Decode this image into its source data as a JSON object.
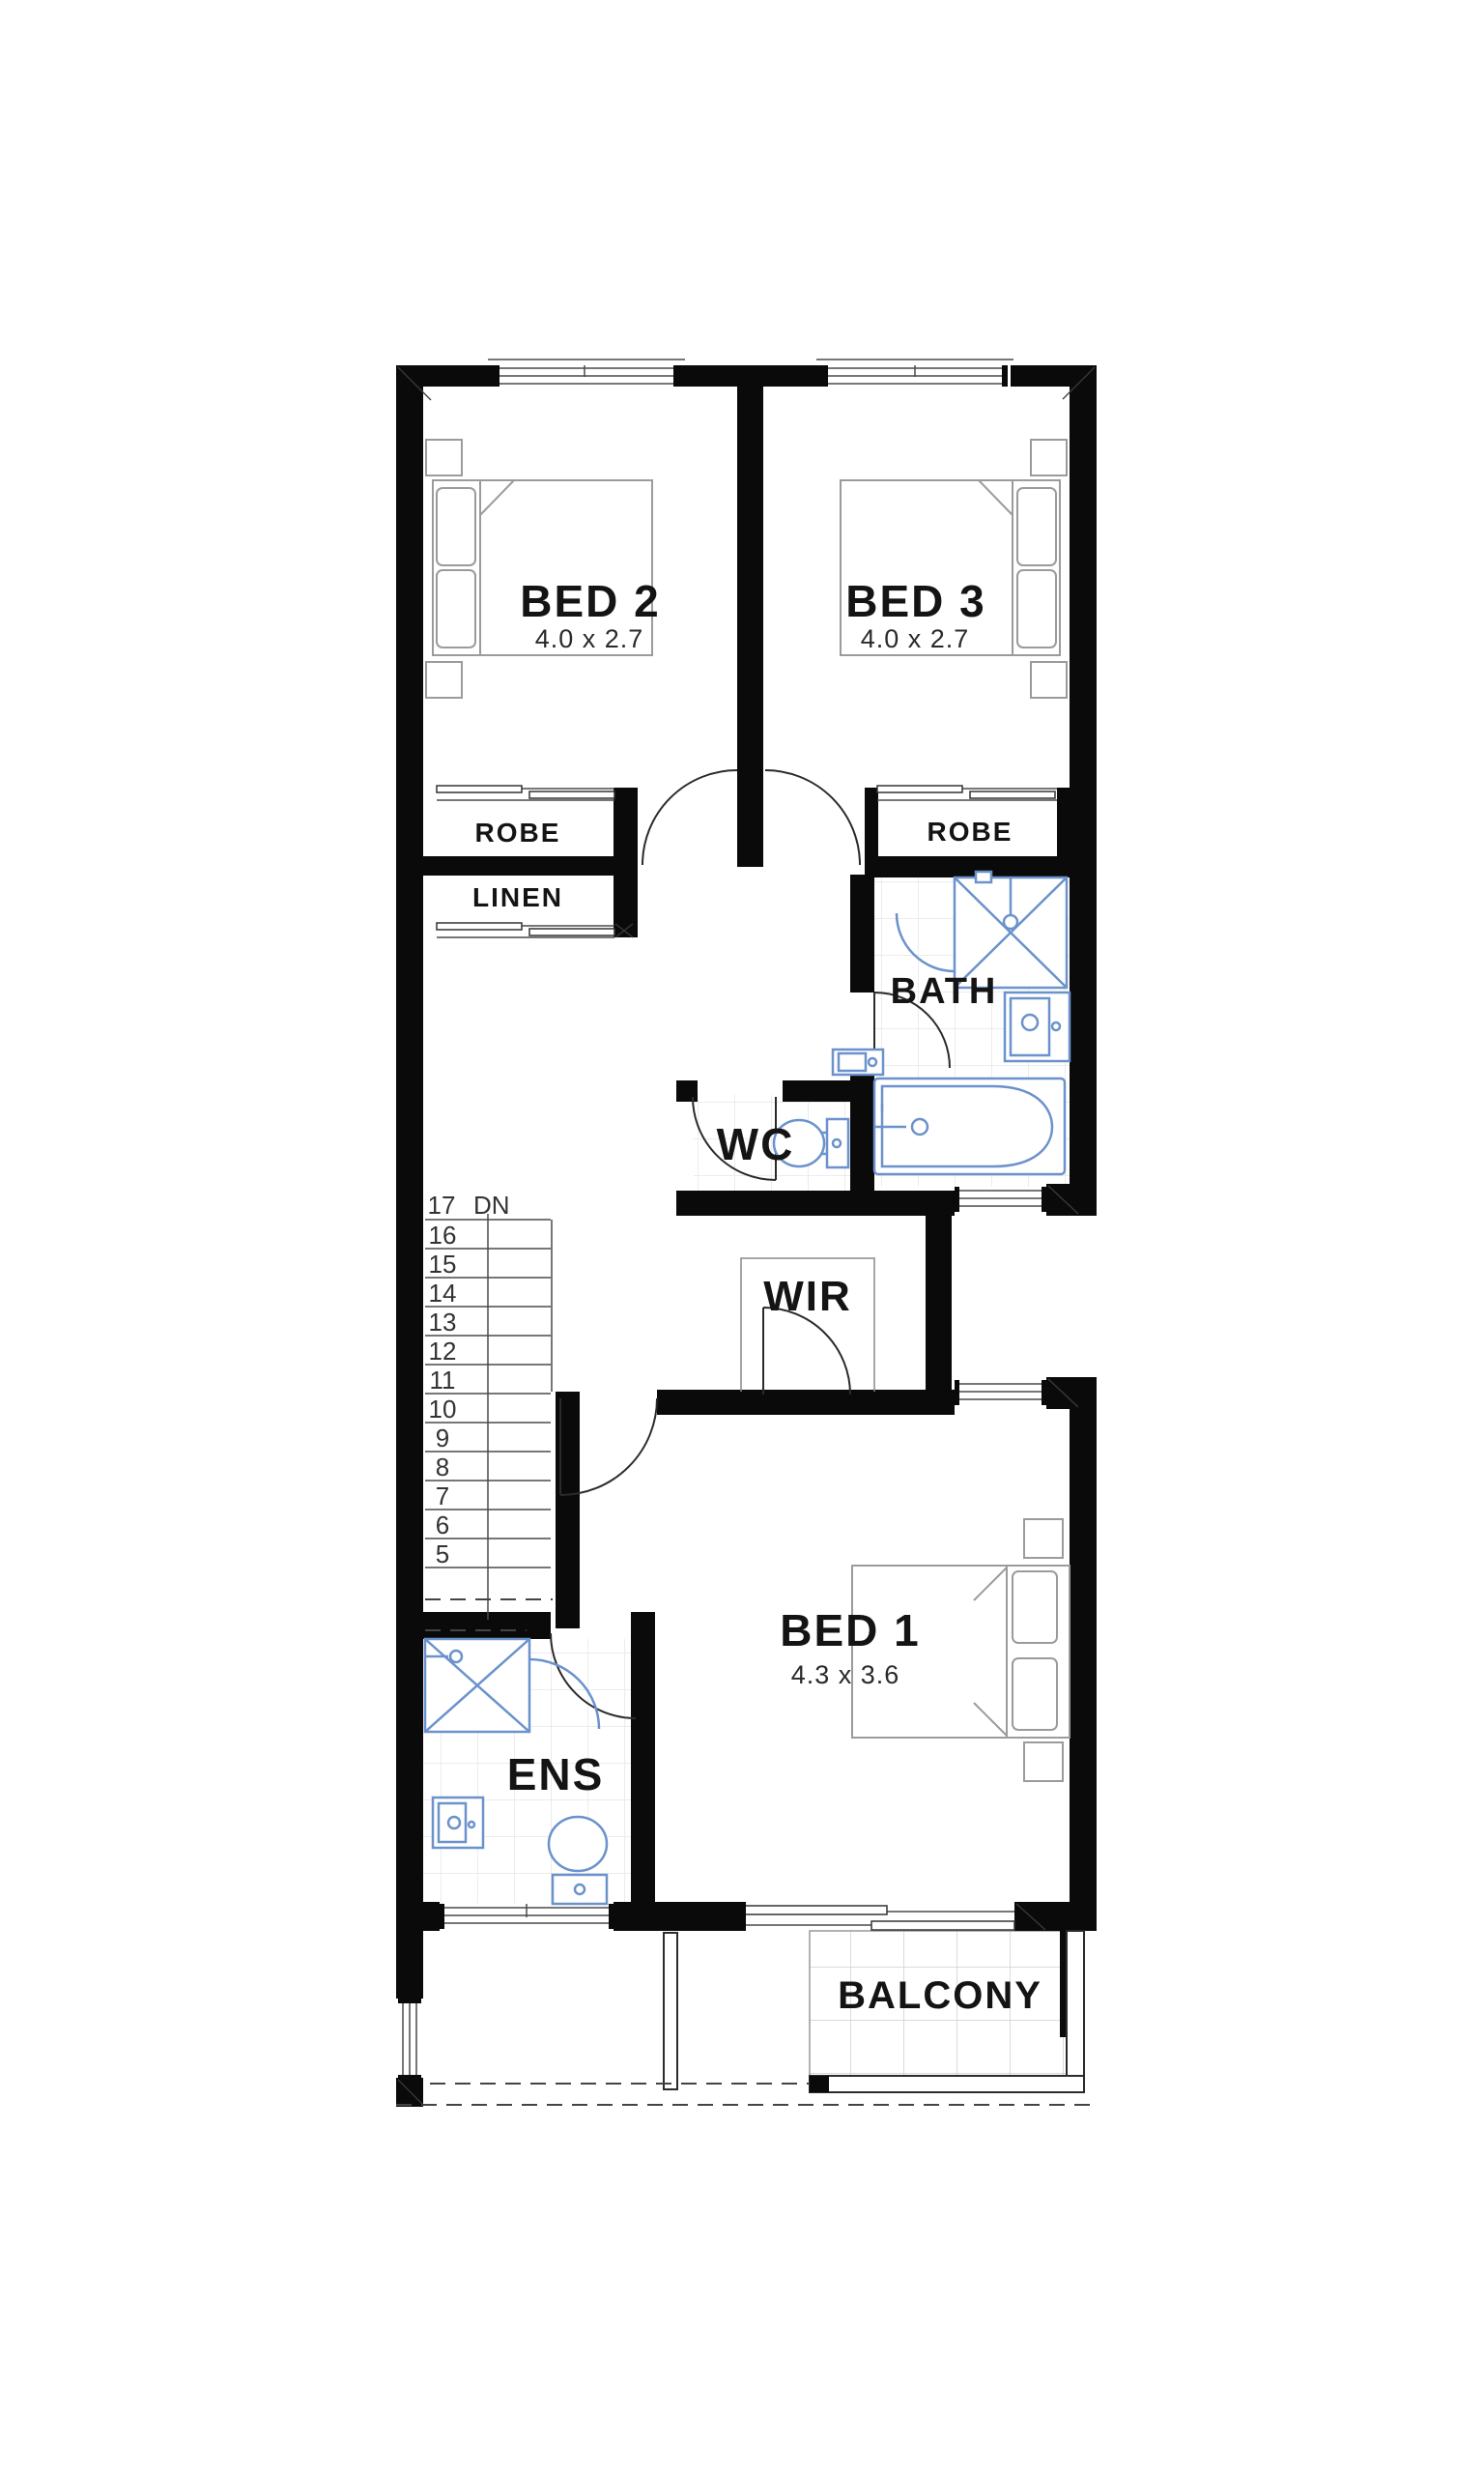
{
  "plan": {
    "type": "floor-plan-upper-level",
    "rooms": {
      "bed2": {
        "label": "BED 2",
        "dims": "4.0 x 2.7"
      },
      "bed3": {
        "label": "BED 3",
        "dims": "4.0 x 2.7"
      },
      "bed1": {
        "label": "BED 1",
        "dims": "4.3 x 3.6"
      },
      "robe_left": {
        "label": "ROBE"
      },
      "robe_right": {
        "label": "ROBE"
      },
      "linen": {
        "label": "LINEN"
      },
      "bath": {
        "label": "BATH"
      },
      "wc": {
        "label": "WC"
      },
      "wir": {
        "label": "WIR"
      },
      "ens": {
        "label": "ENS"
      },
      "balcony": {
        "label": "BALCONY"
      }
    },
    "stairs": {
      "top_number": "17",
      "direction": "DN",
      "treads": [
        "16",
        "15",
        "14",
        "13",
        "12",
        "11",
        "10",
        "9",
        "8",
        "7",
        "6",
        "5"
      ]
    },
    "colors": {
      "wall": "#0a0a0a",
      "fixture_blue": "#6b92cc",
      "tile_line": "#e6e6e6",
      "furniture_line": "#9b9b9b"
    }
  }
}
